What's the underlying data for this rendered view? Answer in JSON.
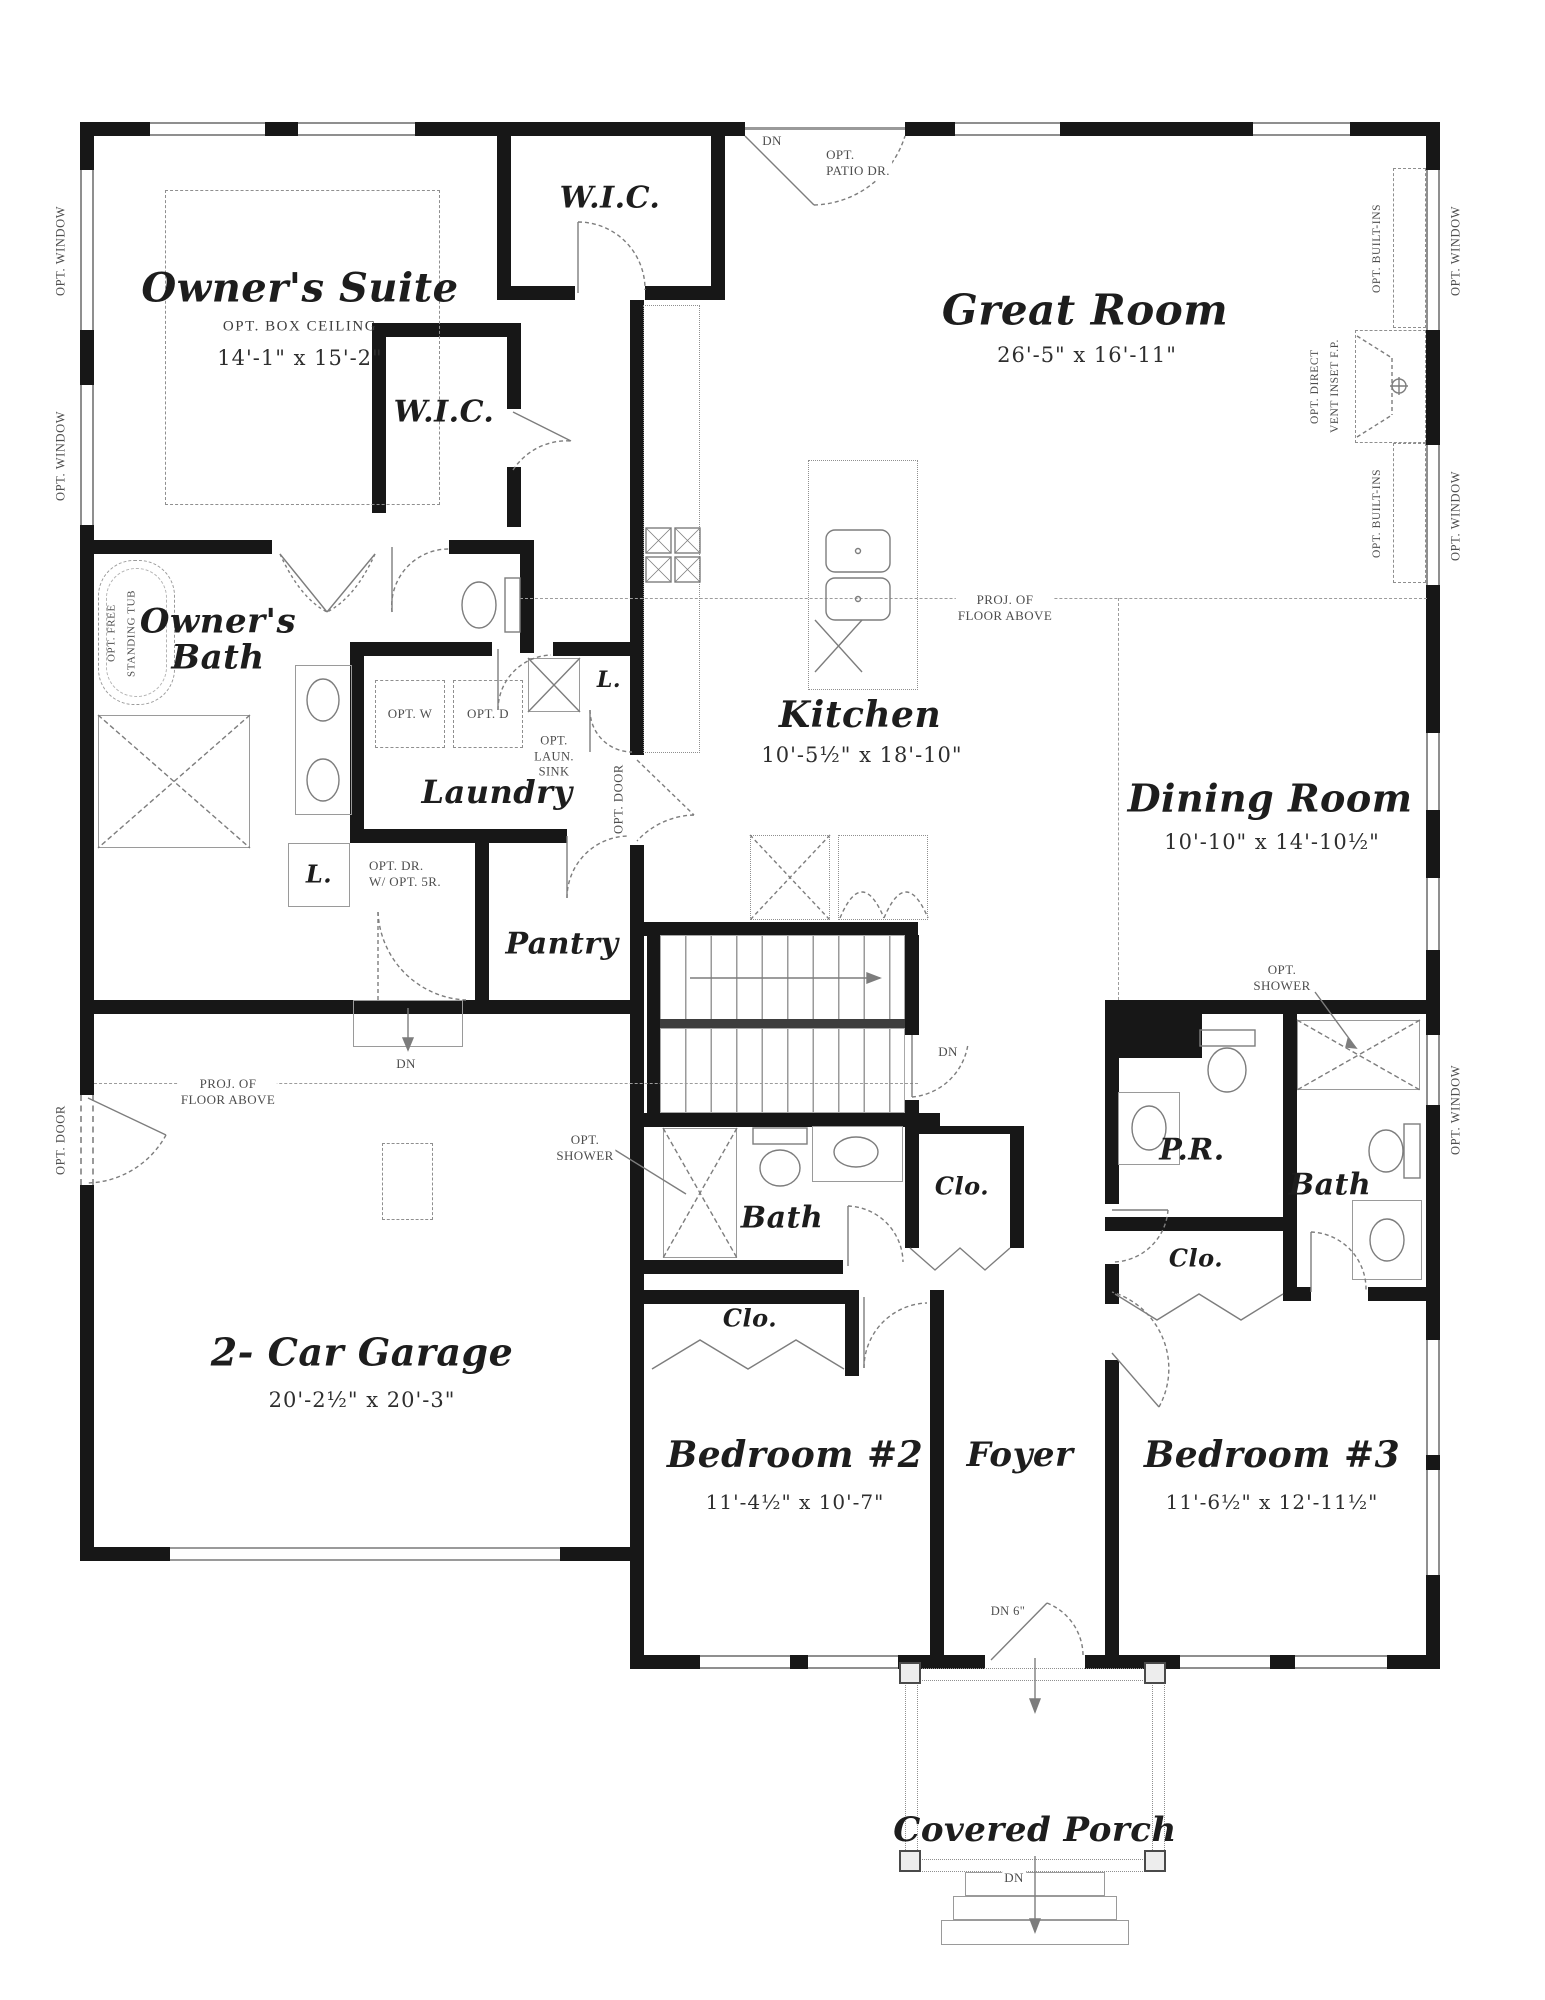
{
  "colors": {
    "wall": "#171717",
    "linework": "#8f8f8f",
    "text": "#1d1d1d",
    "annotation": "#4d4d4d",
    "background": "#ffffff"
  },
  "rooms": {
    "owners_suite": {
      "name": "Owner's Suite",
      "note": "OPT. BOX CEILING",
      "dims": "14'-1\" x 15'-2\""
    },
    "wic_top": {
      "name": "W.I.C."
    },
    "wic_mid": {
      "name": "W.I.C."
    },
    "great_room": {
      "name": "Great Room",
      "dims": "26'-5\" x 16'-11\""
    },
    "owners_bath": {
      "name": "Owner's Bath"
    },
    "laundry": {
      "name": "Laundry"
    },
    "pantry": {
      "name": "Pantry"
    },
    "kitchen": {
      "name": "Kitchen",
      "dims": "10'-5½\" x 18'-10\""
    },
    "dining": {
      "name": "Dining Room",
      "dims": "10'-10\" x 14'-10½\""
    },
    "garage": {
      "name": "2- Car Garage",
      "dims": "20'-2½\" x 20'-3\""
    },
    "bath_main": {
      "name": "Bath"
    },
    "powder": {
      "name": "P.R."
    },
    "bath_right": {
      "name": "Bath"
    },
    "bedroom2": {
      "name": "Bedroom #2",
      "dims": "11'-4½\" x 10'-7\""
    },
    "foyer": {
      "name": "Foyer"
    },
    "bedroom3": {
      "name": "Bedroom #3",
      "dims": "11'-6½\" x 12'-11½\""
    },
    "porch": {
      "name": "Covered Porch"
    },
    "closet": {
      "name": "Clo."
    },
    "linen": {
      "name": "L."
    }
  },
  "annotations": {
    "opt_window": "OPT. WINDOW",
    "opt_door": "OPT. DOOR",
    "opt_patio_1": "OPT.",
    "opt_patio_2": "PATIO DR.",
    "dn": "DN",
    "dn6": "DN 6\"",
    "opt_builtins": "OPT. BUILT-INS",
    "opt_fp_1": "OPT. DIRECT",
    "opt_fp_2": "VENT INSET F.P.",
    "proj_1": "PROJ. OF",
    "proj_2": "FLOOR ABOVE",
    "opt_shower_1": "OPT.",
    "opt_shower_2": "SHOWER",
    "opt_w": "OPT. W",
    "opt_d": "OPT. D",
    "opt_sink_1": "OPT.",
    "opt_sink_2": "LAUN.",
    "opt_sink_3": "SINK",
    "opt_tub_1": "OPT. FREE",
    "opt_tub_2": "STANDING TUB",
    "opt_dr_1": "OPT. DR.",
    "opt_dr_2": "W/ OPT. 5R."
  }
}
